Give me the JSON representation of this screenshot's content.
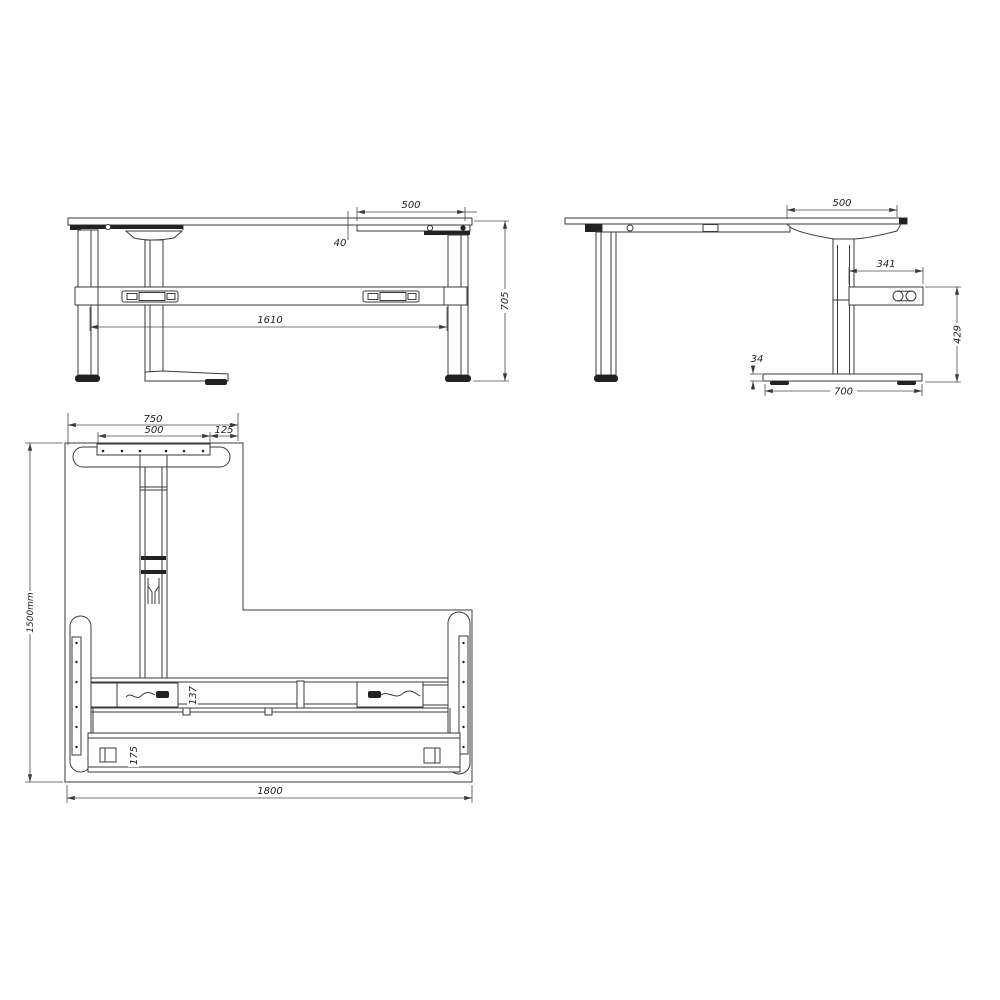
{
  "colors": {
    "line": "#3a3a3a",
    "dark_fill": "#222222",
    "text": "#222222",
    "background": "#ffffff"
  },
  "front_view": {
    "dims": {
      "overhang": "500",
      "rail_gap": "40",
      "beam_span": "1610",
      "height": "705"
    }
  },
  "side_view": {
    "dims": {
      "overhang": "500",
      "box_width": "341",
      "box_to_floor": "429",
      "foot_height": "34",
      "foot_depth": "700"
    }
  },
  "plan_view": {
    "dims": {
      "foot_span": "750",
      "plate_width": "500",
      "edge_offset": "125",
      "depth": "1500mm",
      "beam_width": "137",
      "lower_beam_width": "175",
      "width": "1800"
    }
  }
}
